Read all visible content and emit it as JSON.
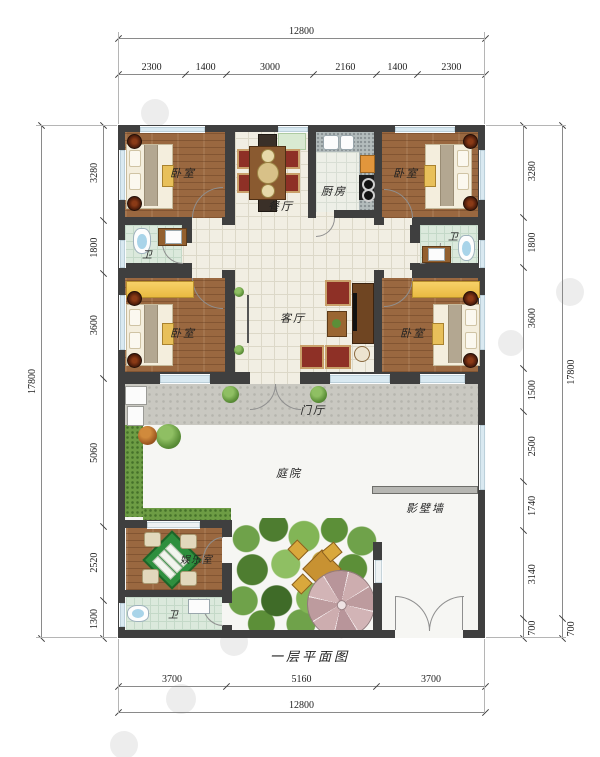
{
  "title": "一层平面图",
  "dims": {
    "top": {
      "overall": "12800",
      "segments": [
        "2300",
        "1400",
        "3000",
        "2160",
        "1400",
        "2300"
      ]
    },
    "bottom": {
      "overall": "12800",
      "segments": [
        "3700",
        "5160",
        "3700"
      ]
    },
    "left": {
      "overall": "17800",
      "segments": [
        "3280",
        "1800",
        "3600",
        "5060",
        "2520",
        "1300"
      ]
    },
    "right": {
      "segments": [
        "3280",
        "1800",
        "3600",
        "1500",
        "2500",
        "1740",
        "3140",
        "700"
      ],
      "outer": [
        "17800",
        "700"
      ]
    }
  },
  "rooms": {
    "bedroom": "卧室",
    "kitchen": "厨房",
    "dining": "餐厅",
    "living": "客厅",
    "bath": "卫",
    "foyer": "门厅",
    "courtyard": "庭院",
    "screen_wall": "影壁墙",
    "entertainment": "娱乐室"
  },
  "colors": {
    "wall": "#3f3f3f",
    "wood_floor": "#9a6840",
    "hall_tile": "#f1eee3",
    "bath_tile": "#dbe9dc",
    "window": "#d9e9f1",
    "wardrobe_yellow": "#f0c75c",
    "sofa_red": "#8e3026",
    "mahjong_green": "#2e8f3e",
    "umbrella_pink": "#c4a3a6",
    "hedge_green": "#6d9c44"
  }
}
